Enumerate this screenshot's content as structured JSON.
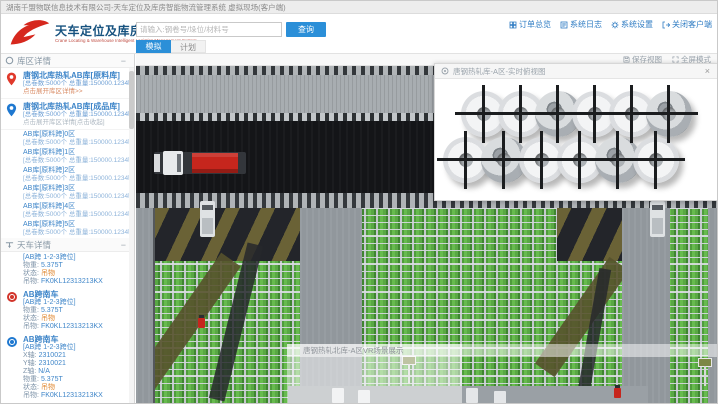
{
  "window_title": "湖南千盟物联信息技术有限公司-天车定位及库房智能物流管理系统 虚拟现场(客户端)",
  "header": {
    "logo_title": "天车定位及库房智能物流管理系统",
    "logo_subtitle": "Crane Locating & Warehouse Intelligent Logistics Management System",
    "search_placeholder": "请输入:钢卷号/垛位/材料号",
    "search_button": "查询",
    "tabs": [
      {
        "label": "模拟",
        "active": true
      },
      {
        "label": "计划",
        "active": false
      }
    ],
    "links": [
      {
        "label": "订单总览",
        "icon": "orders-icon"
      },
      {
        "label": "系统日志",
        "icon": "syslog-icon"
      },
      {
        "label": "系统设置",
        "icon": "settings-icon"
      },
      {
        "label": "关闭客户端",
        "icon": "close-client-icon"
      }
    ]
  },
  "sidebar": {
    "warehouse_section": {
      "title": "库区详情",
      "collapse_label": "−",
      "warehouses": [
        {
          "pin": "red",
          "name": "唐钢北库热轧AB库[原料库]",
          "stats": "[总卷数:5000个 总重量:150000.1234吨]",
          "link": "点击展开库区详情>>"
        },
        {
          "pin": "blue",
          "name": "唐钢北库热轧AB库[成品库]",
          "stats": "[总卷数:5000个 总重量:150000.1234吨]",
          "link": "点击展开库区详情[点击收起]"
        }
      ],
      "zones": [
        {
          "name": "AB库[原料跨]0区",
          "stats": "[总卷数:5000个 总重量:150000.1234吨]"
        },
        {
          "name": "AB库[原料跨]1区",
          "stats": "[总卷数:5000个 总重量:150000.1234吨]"
        },
        {
          "name": "AB库[原料跨]2区",
          "stats": "[总卷数:5000个 总重量:150000.1234吨]"
        },
        {
          "name": "AB库[原料跨]3区",
          "stats": "[总卷数:5000个 总重量:150000.1234吨]"
        },
        {
          "name": "AB库[原料跨]4区",
          "stats": "[总卷数:5000个 总重量:150000.1234吨]"
        },
        {
          "name": "AB库[原料跨]5区",
          "stats": "[总卷数:5000个 总重量:150000.1234吨]"
        }
      ]
    },
    "crane_section": {
      "title": "天车详情",
      "collapse_label": "−",
      "cranes": [
        {
          "icon": "none",
          "name": "",
          "fields": [
            {
              "label": "",
              "value": "[AB跨 1-2-3跨位]"
            },
            {
              "label": "物重:",
              "value": "5.375T"
            },
            {
              "label": "状态:",
              "value": "吊物"
            },
            {
              "label": "吊物:",
              "value": "FK0KL12313213KX"
            }
          ]
        },
        {
          "icon": "red",
          "name": "AB跨南车",
          "fields": [
            {
              "label": "",
              "value": "[AB跨 1-2-3跨位]"
            },
            {
              "label": "物重:",
              "value": "5.375T"
            },
            {
              "label": "状态:",
              "value": "吊物"
            },
            {
              "label": "吊物:",
              "value": "FK0KL12313213KX"
            }
          ]
        },
        {
          "icon": "blue",
          "name": "AB跨南车",
          "fields": [
            {
              "label": "",
              "value": "[AB跨 1-2-3跨位]"
            },
            {
              "label": "X轴:",
              "value": "2310021"
            },
            {
              "label": "Y轴:",
              "value": "2310021"
            },
            {
              "label": "Z轴:",
              "value": "N/A"
            },
            {
              "label": "物重:",
              "value": "5.375T"
            },
            {
              "label": "状态:",
              "value": "吊物"
            },
            {
              "label": "吊物:",
              "value": "FK0KL12313213KX"
            }
          ]
        }
      ]
    }
  },
  "viewport": {
    "toolbar": {
      "save_view": "保存视图",
      "fullscreen": "全屏模式"
    },
    "coil_panel": {
      "title": "唐钢热轧库-A区-实时俯视图",
      "close_label": "×",
      "coil_rows": [
        6,
        6
      ]
    },
    "bottom_overlay": {
      "label": "唐钢热轧北库-A区VR场景展示"
    }
  },
  "colors": {
    "accent_blue": "#2b8fd8",
    "logo_red": "#d6281e",
    "logo_blue": "#16527f",
    "link_blue": "#2f7cc3",
    "rack_green": "#59a844",
    "status_orange": "#e0872f"
  }
}
